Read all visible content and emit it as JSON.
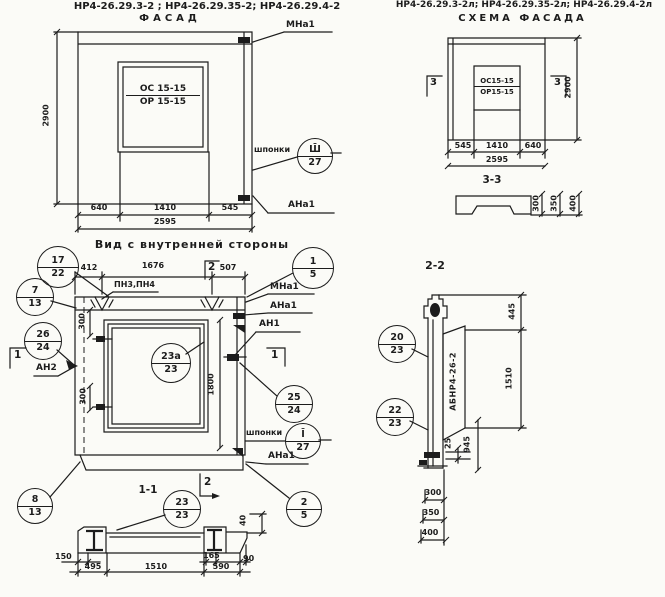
{
  "header": {
    "facade_codes": "НР4-26.29.3-2 ;  НР4-26.29.35-2;  НР4-26.29.4-2",
    "facade_title": "ФАСАД",
    "scheme_codes": "НР4-26.29.3-2л; НР4-26.29.35-2л; НР4-26.29.4-2л",
    "scheme_title": "СХЕМА ФАСАДА"
  },
  "facade": {
    "window_top": "ОС 15-15",
    "window_bot": "ОР 15-15",
    "dim_height": "2900",
    "dim_a": "640",
    "dim_b": "1410",
    "dim_c": "545",
    "dim_total": "2595",
    "label_mna1": "МНа1",
    "label_shponki": "шпонки",
    "label_ana1": "АНа1"
  },
  "scheme": {
    "window_top": "ОС15-15",
    "window_bot": "ОР15-15",
    "dim_height": "2900",
    "dim_a": "545",
    "dim_b": "1410",
    "dim_c": "640",
    "dim_total": "2595",
    "marker3": "3",
    "section_label": "3-3",
    "dim33_a": "300",
    "dim33_b": "350",
    "dim33_c": "400"
  },
  "inner": {
    "title": "Вид с внутренней стороны",
    "dim_a": "412",
    "dim_b": "1676",
    "dim_c": "507",
    "label_pn": "ПН3,ПН4",
    "label_mna1": "МНа1",
    "label_ana1": "АНа1",
    "label_an1": "АН1",
    "label_an2": "АН2",
    "label_shponki": "шпонки",
    "label_ana1_b": "АНа1",
    "dim_300_top": "300",
    "dim_300_bot": "300",
    "dim_1800": "1800",
    "marker1_left": "1",
    "marker1_right": "1",
    "marker2_top": "2",
    "marker2_bot": "2"
  },
  "sec11": {
    "title": "1-1",
    "dim_40": "40",
    "dim_150": "150",
    "dim_495": "495",
    "dim_1510": "1510",
    "dim_165": "165",
    "dim_590": "590",
    "dim_90": "90"
  },
  "sec22": {
    "title": "2-2",
    "plate_label": "АБНР4-26-2",
    "dim_445": "445",
    "dim_1510": "1510",
    "dim_25": "25",
    "dim_945": "945",
    "dim_a": "300",
    "dim_b": "350",
    "dim_c": "400"
  },
  "callouts": {
    "c17_22": {
      "top": "17",
      "bot": "22"
    },
    "c7_13": {
      "top": "7",
      "bot": "13"
    },
    "c1_5": {
      "top": "1",
      "bot": "5"
    },
    "c26_24": {
      "top": "26",
      "bot": "24"
    },
    "c23a_23": {
      "top": "23а",
      "bot": "23"
    },
    "c25_24": {
      "top": "25",
      "bot": "24"
    },
    "cSh_27": {
      "top": "Ш̄",
      "bot": "27"
    },
    "c1_27": {
      "top": "Ī",
      "bot": "27"
    },
    "c8_13": {
      "top": "8",
      "bot": "13"
    },
    "c2_5": {
      "top": "2",
      "bot": "5"
    },
    "c23_23": {
      "top": "23",
      "bot": "23"
    },
    "c20_23": {
      "top": "20",
      "bot": "23"
    },
    "c22_23": {
      "top": "22",
      "bot": "23"
    }
  }
}
